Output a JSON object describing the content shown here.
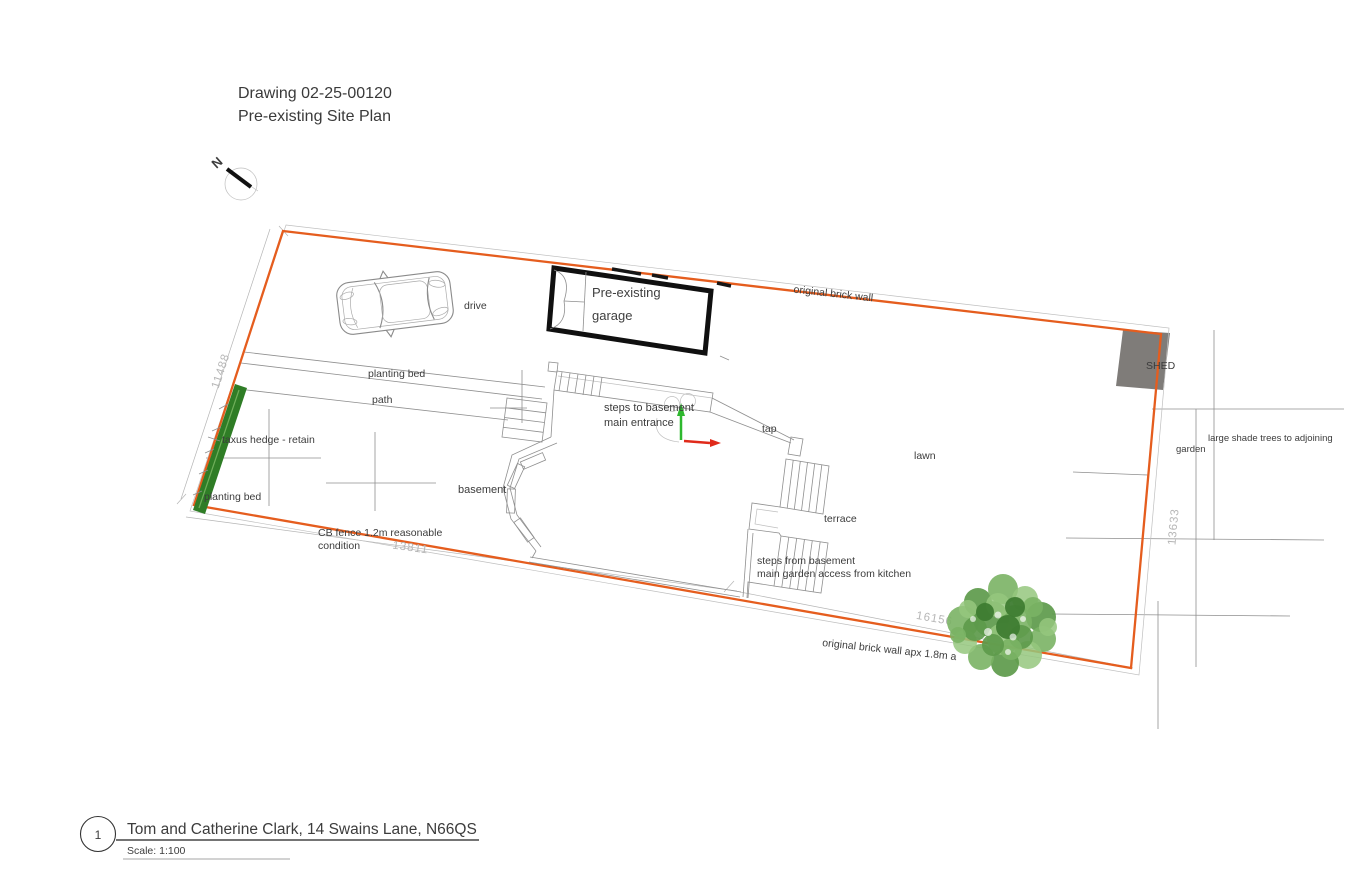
{
  "header": {
    "line1": "Drawing 02-25-00120",
    "line2": "Pre-existing Site Plan"
  },
  "north": {
    "label": "N"
  },
  "site_labels": {
    "drive": "drive",
    "garage_line1": "Pre-existing",
    "garage_line2": "garage",
    "brick_wall_top": "original brick wall",
    "shed": "SHED",
    "planting_bed_upper": "planting bed",
    "path": "path",
    "taxus_hedge": "taxus hedge - retain",
    "planting_bed_lower": "planting bed",
    "basement": "basement",
    "steps_to_basement_line1": "steps to basement",
    "steps_to_basement_line2": "main entrance",
    "tap": "tap",
    "lawn": "lawn",
    "terrace": "terrace",
    "steps_from_basement_line1": "steps from basement",
    "steps_from_basement_line2": "main garden access from kitchen",
    "cb_fence_line1": "CB fence 1.2m reasonable",
    "cb_fence_line2": "condition",
    "brick_wall_bottom": "original brick wall apx 1.8m a",
    "adjoining_trees_line1": "large shade trees to adjoining",
    "adjoining_trees_line2": "garden"
  },
  "dimensions": {
    "left_boundary": "11488",
    "bottom_left_boundary": "13811",
    "bottom_right_boundary": "16156",
    "right_boundary": "13633"
  },
  "footer": {
    "sheet_number": "1",
    "project_title": "Tom and Catherine Clark, 14 Swains Lane, N66QS",
    "scale": "Scale: 1:100"
  },
  "colors": {
    "boundary": "#e55d1e",
    "hedge": "#2f7d26",
    "hedge-light": "#6fae5a",
    "shed": "#7f7c79",
    "axis-green": "#2eb82e",
    "axis-red": "#e02a1a",
    "label": "#3c3c3c",
    "dim": "#b6b6b6",
    "line": "#8f8f8f",
    "tree1": "#5d9a4b",
    "tree2": "#7ab364",
    "tree3": "#95c77e",
    "tree4": "#3e7c31"
  }
}
